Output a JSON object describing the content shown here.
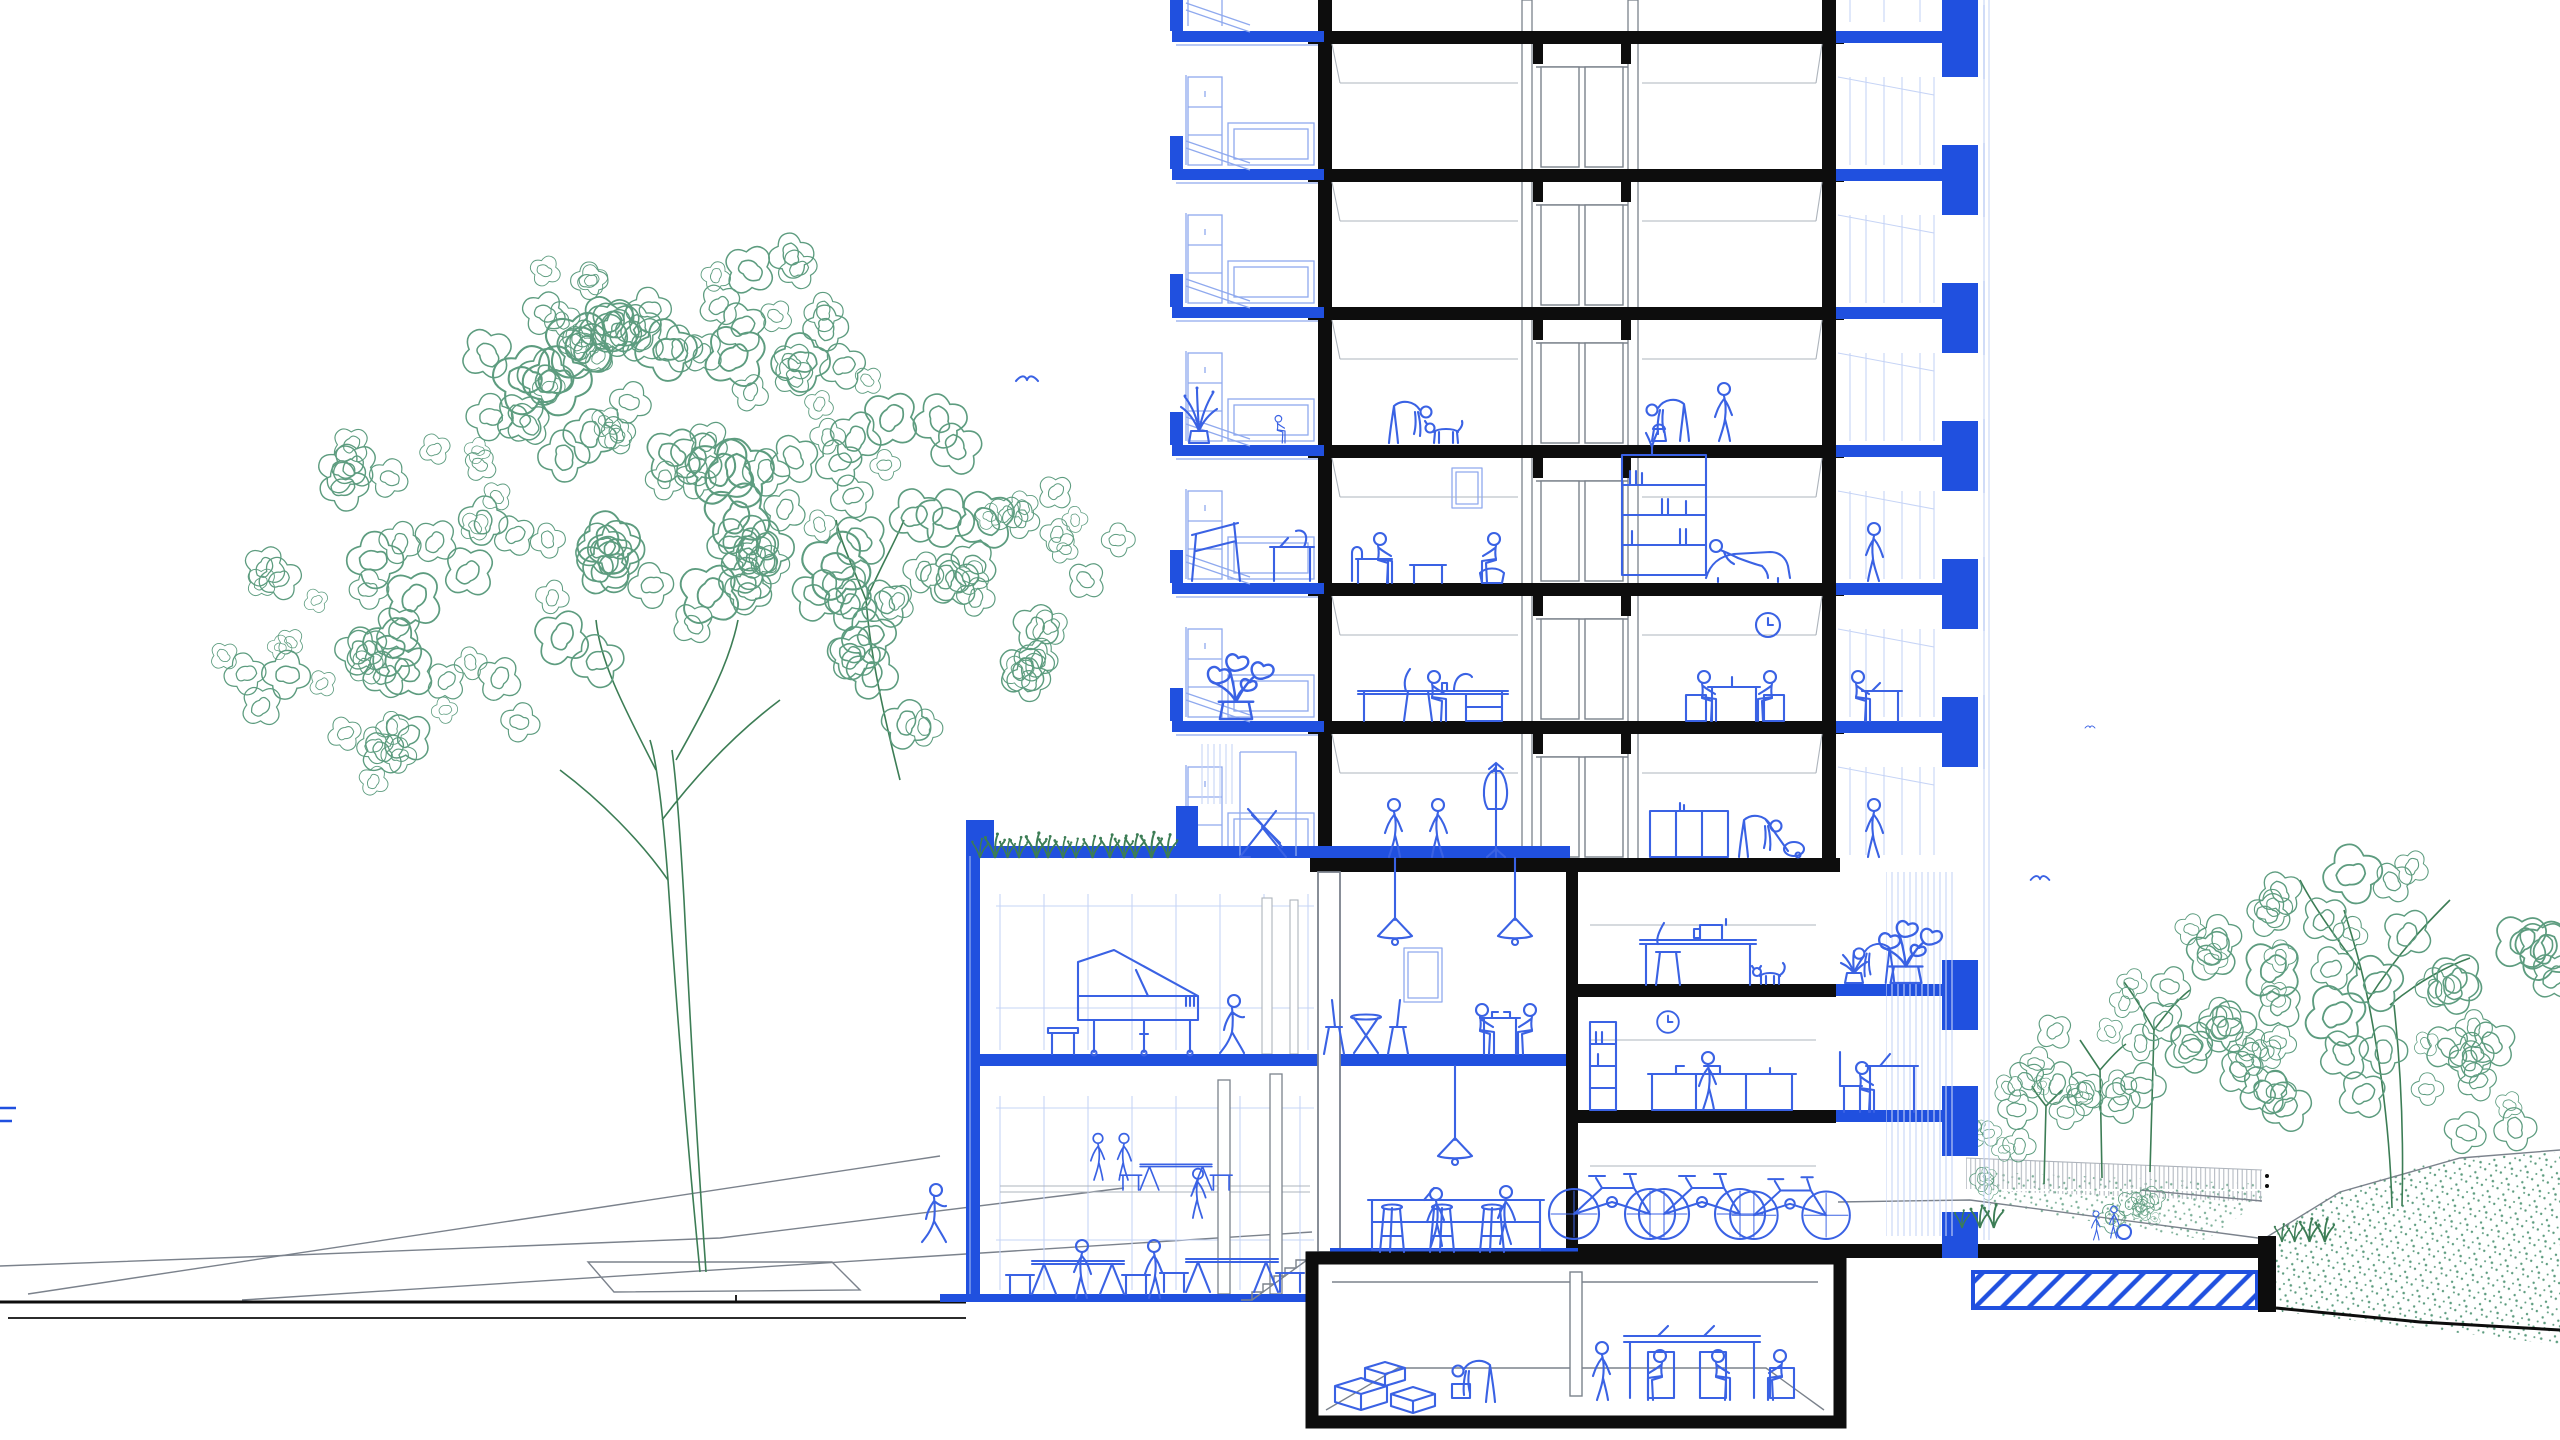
{
  "meta": {
    "title": "Architectural cross-section drawing of a residential tower with podium, basement, street and garden",
    "drawing_style": "line art: black = cut structure, blue = balconies/interior life, green = vegetation"
  },
  "palette": {
    "paper": "#ffffff",
    "ink": "#0d0d0d",
    "gray": "#7b828c",
    "grayL": "#aeb4bc",
    "blue": "#2050df",
    "blueM": "#3a62e4",
    "blueL": "#8fa9ee",
    "blueXL": "#c6d4f6",
    "green": "#5d9c7f",
    "greenD": "#3c7d55"
  },
  "inventory": {
    "tower": "8+ storey section: core with double doors, left balconies with parapets, right loggias with planter blocks",
    "scenes": [
      "person petting dog",
      "child on balcony",
      "person with bucket",
      "person on phone",
      "couple on sofa",
      "reading woman on loggia",
      "home office desk",
      "couple at table",
      "wall clock",
      "people talking",
      "coat stand",
      "person vacuuming",
      "deck chair on roof terrace"
    ],
    "podium": [
      "green roof with grasses",
      "music room with grand piano",
      "walking woman",
      "cafe with pendant lamps and bistro tables",
      "community hall with picnic tables",
      "bar with stools",
      "sewing room with cat",
      "kitchen",
      "bicycle storage"
    ],
    "basement": [
      "storage boxes",
      "person lifting box",
      "meeting table with laptops"
    ],
    "site": [
      "large street tree with tree pit",
      "pedestrian on phone",
      "row of garden trees",
      "fence",
      "children playing ball",
      "hatched structural slab",
      "retaining wall",
      "stippled planting"
    ]
  },
  "seed": 7,
  "placements": [
    {
      "n": "plant-tall",
      "s": "plantTall",
      "x": 1199,
      "y": 443,
      "sc": 1,
      "fx": 1
    },
    {
      "n": "child-sitting",
      "s": "pSit",
      "x": 1274,
      "y": 443,
      "sc": 0.55,
      "fx": 1
    },
    {
      "n": "person-petting-dog",
      "s": "pBend",
      "x": 1404,
      "y": 443,
      "sc": 1,
      "fx": -1
    },
    {
      "n": "dog",
      "s": "dog",
      "x": 1446,
      "y": 443,
      "sc": 1,
      "fx": 1
    },
    {
      "n": "person-with-bucket",
      "s": "pBend",
      "x": 1674,
      "y": 441,
      "sc": 1,
      "fx": 1
    },
    {
      "n": "person-on-phone",
      "s": "pStand",
      "x": 1724,
      "y": 441,
      "sc": 1,
      "fx": 1
    },
    {
      "n": "person-sitting-left",
      "s": "pSit",
      "x": 1372,
      "y": 583,
      "sc": 1,
      "fx": 1
    },
    {
      "n": "person-sitting-right",
      "s": "pSit",
      "x": 1502,
      "y": 583,
      "sc": 1,
      "fx": -1
    },
    {
      "n": "person-lounging",
      "s": "pLounge",
      "x": 1712,
      "y": 578,
      "sc": 1,
      "fx": 1
    },
    {
      "n": "woman-reading-loggia",
      "s": "pStand",
      "x": 1874,
      "y": 581,
      "sc": 1,
      "fx": -1
    },
    {
      "n": "person-at-desk",
      "s": "pSit",
      "x": 1426,
      "y": 721,
      "sc": 1,
      "fx": 1
    },
    {
      "n": "person-at-table-left",
      "s": "pSit",
      "x": 1696,
      "y": 721,
      "sc": 1,
      "fx": 1
    },
    {
      "n": "person-at-table-right",
      "s": "pSit",
      "x": 1778,
      "y": 721,
      "sc": 1,
      "fx": -1
    },
    {
      "n": "person-loggia-desk",
      "s": "pSit",
      "x": 1850,
      "y": 721,
      "sc": 1,
      "fx": 1
    },
    {
      "n": "wall-clock",
      "s": "clockSym",
      "x": 1768,
      "y": 625,
      "sc": 1,
      "fx": 1
    },
    {
      "n": "monstera-balcony",
      "s": "monstera",
      "x": 1236,
      "y": 719,
      "sc": 1.15,
      "fx": 1
    },
    {
      "n": "person-talking-a",
      "s": "pStand",
      "x": 1394,
      "y": 857,
      "sc": 1,
      "fx": 1
    },
    {
      "n": "person-talking-b",
      "s": "pStand",
      "x": 1438,
      "y": 857,
      "sc": 1,
      "fx": -1
    },
    {
      "n": "person-vacuuming",
      "s": "pBend",
      "x": 1754,
      "y": 857,
      "sc": 1,
      "fx": -1
    },
    {
      "n": "woman-at-window",
      "s": "pStand",
      "x": 1874,
      "y": 857,
      "sc": 1,
      "fx": -1
    },
    {
      "n": "walking-woman-piano-room",
      "s": "pWalk",
      "x": 1232,
      "y": 1054,
      "sc": 1,
      "fx": 1
    },
    {
      "n": "cafe-guest-left",
      "s": "pSit",
      "x": 1474,
      "y": 1054,
      "sc": 1,
      "fx": 1
    },
    {
      "n": "cafe-guest-right",
      "s": "pSit",
      "x": 1538,
      "y": 1054,
      "sc": 1,
      "fx": -1
    },
    {
      "n": "monstera-sewing-balcony",
      "s": "monstera",
      "x": 1906,
      "y": 983,
      "sc": 1.1,
      "fx": 1
    },
    {
      "n": "aloe-pot",
      "s": "aloe",
      "x": 1854,
      "y": 983,
      "sc": 1,
      "fx": 1
    },
    {
      "n": "person-watering-plants",
      "s": "pBend",
      "x": 1880,
      "y": 983,
      "sc": 0.95,
      "fx": 1
    },
    {
      "n": "kitchen-clock",
      "s": "clockSym",
      "x": 1668,
      "y": 1022,
      "sc": 0.9,
      "fx": 1
    },
    {
      "n": "person-cooking",
      "s": "pStand",
      "x": 1708,
      "y": 1110,
      "sc": 1,
      "fx": 1
    },
    {
      "n": "woman-laptop-balcony",
      "s": "pSit",
      "x": 1854,
      "y": 1112,
      "sc": 1,
      "fx": 1
    },
    {
      "n": "cat",
      "s": "cat",
      "x": 1770,
      "y": 984,
      "sc": 1,
      "fx": 1
    },
    {
      "n": "picnic-table-1",
      "s": "picnic",
      "x": 1078,
      "y": 1294,
      "sc": 1,
      "fx": 1
    },
    {
      "n": "picnic-table-2",
      "s": "picnic",
      "x": 1232,
      "y": 1292,
      "sc": 1,
      "fx": 1
    },
    {
      "n": "picnic-table-bg",
      "s": "picnic",
      "x": 1176,
      "y": 1190,
      "sc": 0.78,
      "fx": 1
    },
    {
      "n": "handshake-a",
      "s": "pStand",
      "x": 1098,
      "y": 1180,
      "sc": 0.8,
      "fx": 1
    },
    {
      "n": "handshake-b",
      "s": "pStand",
      "x": 1124,
      "y": 1180,
      "sc": 0.8,
      "fx": -1
    },
    {
      "n": "woman-standing-bg",
      "s": "pStand",
      "x": 1198,
      "y": 1218,
      "sc": 0.85,
      "fx": -1
    },
    {
      "n": "person-hall-a",
      "s": "pStand",
      "x": 1082,
      "y": 1298,
      "sc": 1,
      "fx": -1
    },
    {
      "n": "person-hall-b",
      "s": "pStand",
      "x": 1154,
      "y": 1298,
      "sc": 1,
      "fx": 1
    },
    {
      "n": "bar-stool-1",
      "s": "barStool",
      "x": 1392,
      "y": 1252,
      "sc": 1,
      "fx": 1
    },
    {
      "n": "bar-stool-2",
      "s": "barStool",
      "x": 1442,
      "y": 1252,
      "sc": 1,
      "fx": 1
    },
    {
      "n": "bar-stool-3",
      "s": "barStool",
      "x": 1492,
      "y": 1252,
      "sc": 1,
      "fx": 1
    },
    {
      "n": "barista-laptop",
      "s": "pStand",
      "x": 1436,
      "y": 1246,
      "sc": 1,
      "fx": 1
    },
    {
      "n": "barista",
      "s": "pStand",
      "x": 1506,
      "y": 1244,
      "sc": 1,
      "fx": -1
    },
    {
      "n": "bicycle-1",
      "s": "bike",
      "x": 1612,
      "y": 1239,
      "sc": 1,
      "fx": 1
    },
    {
      "n": "bicycle-2",
      "s": "bike",
      "x": 1702,
      "y": 1239,
      "sc": 1,
      "fx": 1
    },
    {
      "n": "bicycle-3",
      "s": "bike",
      "x": 1790,
      "y": 1239,
      "sc": 0.95,
      "fx": 1
    },
    {
      "n": "person-lifting-box",
      "s": "pBend",
      "x": 1480,
      "y": 1402,
      "sc": 1,
      "fx": 1
    },
    {
      "n": "person-standing-meeting",
      "s": "pStand",
      "x": 1602,
      "y": 1400,
      "sc": 1,
      "fx": 1
    },
    {
      "n": "meeting-person-a",
      "s": "pSit",
      "x": 1668,
      "y": 1400,
      "sc": 1,
      "fx": -1
    },
    {
      "n": "meeting-person-b",
      "s": "pSit",
      "x": 1710,
      "y": 1400,
      "sc": 1,
      "fx": 1
    },
    {
      "n": "person-on-box",
      "s": "pSit",
      "x": 1788,
      "y": 1400,
      "sc": 1,
      "fx": -1
    },
    {
      "n": "pedestrian-on-phone",
      "s": "pWalk",
      "x": 934,
      "y": 1243,
      "sc": 1,
      "fx": 1
    },
    {
      "n": "child-with-ball-a",
      "s": "pStand",
      "x": 2096,
      "y": 1240,
      "sc": 0.5,
      "fx": 1
    },
    {
      "n": "child-with-ball-b",
      "s": "pStand",
      "x": 2114,
      "y": 1238,
      "sc": 0.55,
      "fx": -1
    }
  ],
  "trees": [
    {
      "g": "folL",
      "cx": 690,
      "cy": 470,
      "r": 200,
      "n": 40,
      "sc": 1.15
    },
    {
      "g": "folL",
      "cx": 500,
      "cy": 610,
      "r": 140,
      "n": 22,
      "sc": 1.0
    },
    {
      "g": "folL",
      "cx": 565,
      "cy": 360,
      "r": 120,
      "n": 18,
      "sc": 0.95
    },
    {
      "g": "folL",
      "cx": 880,
      "cy": 520,
      "r": 145,
      "n": 24,
      "sc": 1.0
    },
    {
      "g": "folL",
      "cx": 360,
      "cy": 710,
      "r": 100,
      "n": 14,
      "sc": 0.85
    },
    {
      "g": "folL",
      "cx": 955,
      "cy": 655,
      "r": 105,
      "n": 15,
      "sc": 0.9
    },
    {
      "g": "folL",
      "cx": 785,
      "cy": 330,
      "r": 105,
      "n": 15,
      "sc": 0.9
    },
    {
      "g": "folL",
      "cx": 1045,
      "cy": 560,
      "r": 85,
      "n": 11,
      "sc": 0.8
    },
    {
      "g": "folL",
      "cx": 250,
      "cy": 620,
      "r": 70,
      "n": 8,
      "sc": 0.75
    },
    {
      "g": "folL",
      "cx": 430,
      "cy": 470,
      "r": 90,
      "n": 12,
      "sc": 0.85
    },
    {
      "g": "folR",
      "cx": 2400,
      "cy": 950,
      "r": 160,
      "n": 26,
      "sc": 1.05
    },
    {
      "g": "folR",
      "cx": 2480,
      "cy": 1080,
      "r": 70,
      "n": 8,
      "sc": 0.8
    },
    {
      "g": "folR",
      "cx": 2300,
      "cy": 1050,
      "r": 85,
      "n": 11,
      "sc": 0.85
    },
    {
      "g": "folR",
      "cx": 2195,
      "cy": 995,
      "r": 90,
      "n": 13,
      "sc": 0.85
    },
    {
      "g": "folR",
      "cx": 2108,
      "cy": 1058,
      "r": 65,
      "n": 9,
      "sc": 0.75
    },
    {
      "g": "folR",
      "cx": 2040,
      "cy": 1098,
      "r": 48,
      "n": 7,
      "sc": 0.65
    },
    {
      "g": "folR",
      "cx": 1996,
      "cy": 1128,
      "r": 34,
      "n": 5,
      "sc": 0.55
    },
    {
      "g": "folR",
      "cx": 2122,
      "cy": 1203,
      "r": 24,
      "n": 5,
      "sc": 0.5
    },
    {
      "g": "folR",
      "cx": 2152,
      "cy": 1206,
      "r": 20,
      "n": 4,
      "sc": 0.45
    },
    {
      "g": "folR",
      "cx": 1984,
      "cy": 1180,
      "r": 14,
      "n": 3,
      "sc": 0.4
    }
  ],
  "grass": [
    {
      "x1": 980,
      "x2": 1172,
      "y": 858
    },
    {
      "x1": 1962,
      "x2": 1996,
      "y": 1228
    },
    {
      "x1": 2282,
      "x2": 2332,
      "y": 1242
    }
  ],
  "birds": [
    {
      "x": 1027,
      "y": 381,
      "sc": 1
    },
    {
      "x": 2040,
      "y": 880,
      "sc": 0.85
    },
    {
      "x": 2090,
      "y": 728,
      "sc": 0.45
    }
  ]
}
